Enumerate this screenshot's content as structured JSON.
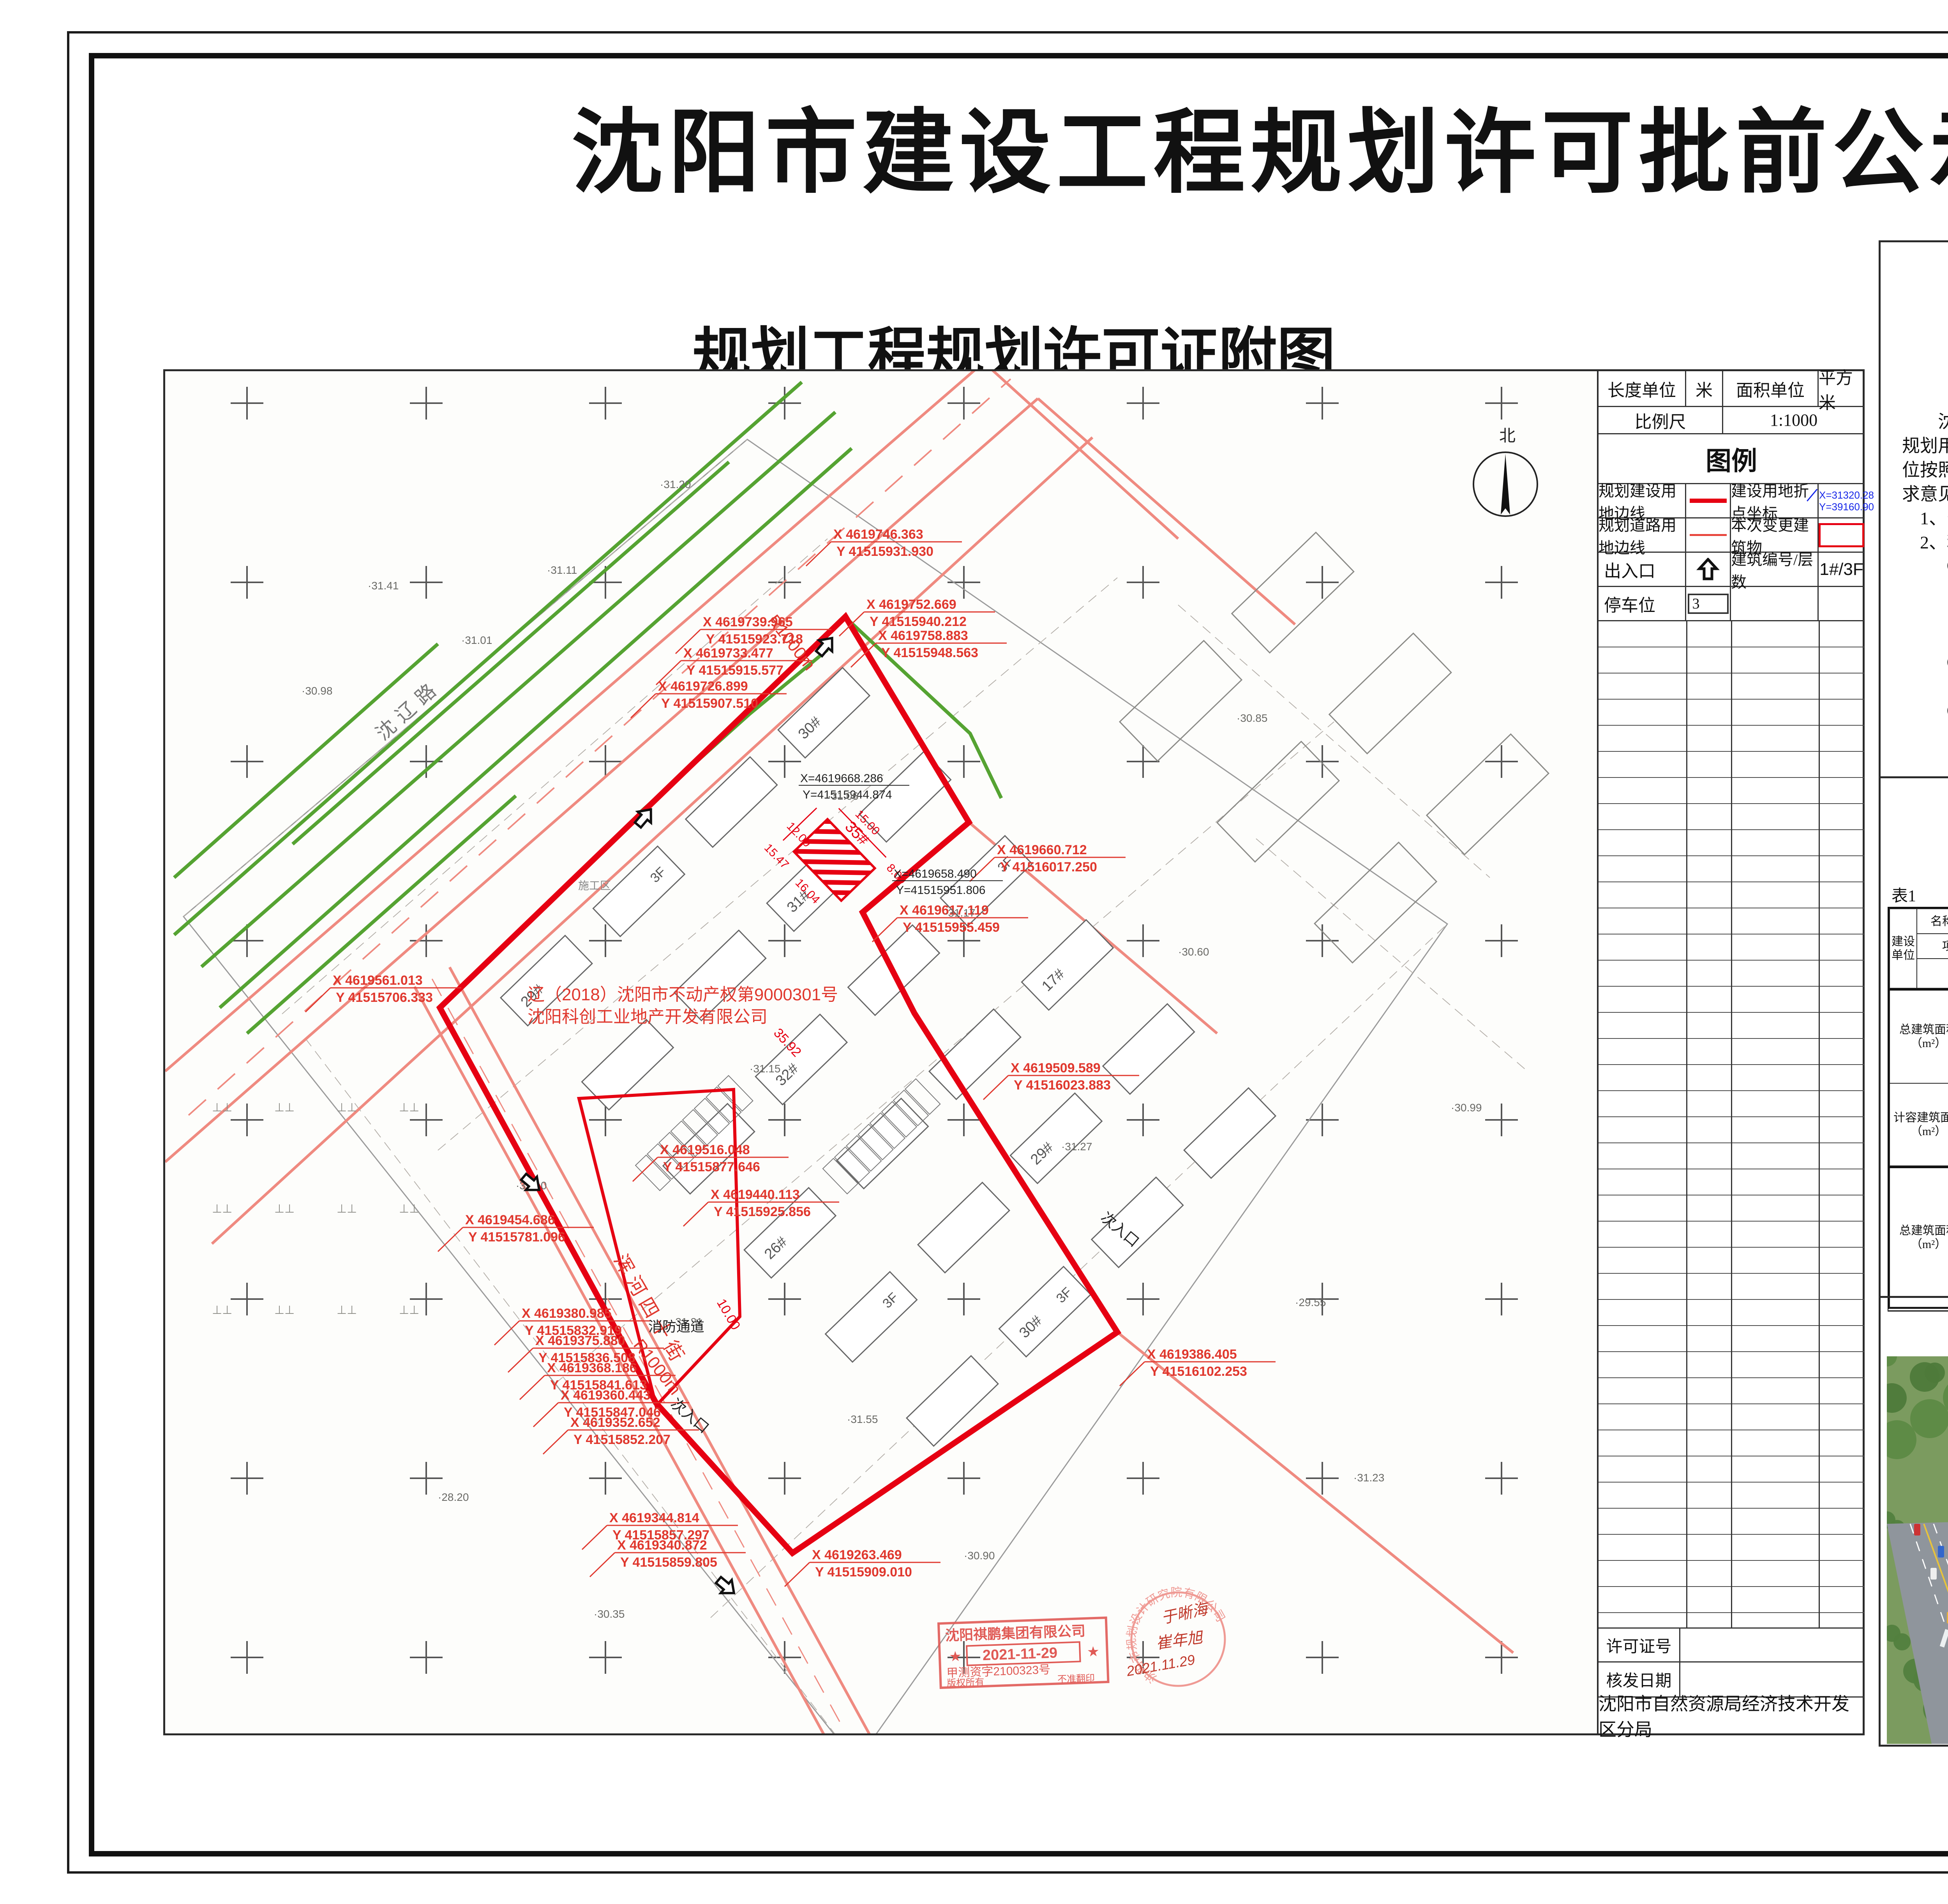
{
  "page_title": "沈阳市建设工程规划许可批前公示板",
  "map_sheet": {
    "title": "规划工程规划许可证附图",
    "units_row": {
      "length_label": "长度单位",
      "length_value": "米",
      "area_label": "面积单位",
      "area_value": "平方米"
    },
    "scale_row": {
      "label": "比例尺",
      "value": "1:1000"
    },
    "legend": {
      "header": "图例",
      "row1_left": "规划建设用地边线",
      "row1_right": "建设用地折点坐标",
      "row1_sample_x": "X=31320.28",
      "row1_sample_y": "Y=39160.90",
      "row2_left": "规划道路用地边线",
      "row2_right": "本次变更建筑物",
      "row3_left": "出入口",
      "row3_right": "建筑编号/层数",
      "row3_value": "1#/3F",
      "row4_left": "停车位",
      "row4_value": "3"
    },
    "footer": {
      "permit_no_label": "许可证号",
      "permit_no_value": "",
      "issue_date_label": "核发日期",
      "issue_date_value": "",
      "agency": "沈阳市自然资源局经济技术开发区分局"
    },
    "north_label": "北",
    "annotations": {
      "property_line1": "辽（2018）沈阳市不动产权第9000301号",
      "property_line2": "沈阳科创工业地产开发有限公司",
      "road_shenliao": "沈辽路",
      "road_hunhe": "浑河四十街",
      "radius_label": "R1000m",
      "secondary_entrance": "次入口",
      "main_entrance": "主入口",
      "fire_lane": "消防通道",
      "dim_10": "10.00",
      "construction_zone": "施工区",
      "building35": "35#",
      "dims": [
        "15.00",
        "8.00",
        "12.00",
        "15.47",
        "16.04",
        "35.92"
      ],
      "black_coords": [
        [
          "X=4619668.286",
          "Y=41515944.874"
        ],
        [
          "X=4619658.490",
          "Y=41515951.806"
        ]
      ],
      "red_coords": [
        [
          "X 4619746.363",
          "Y 41515931.930"
        ],
        [
          "X 4619752.669",
          "Y 41515940.212"
        ],
        [
          "X 4619758.883",
          "Y 41515948.563"
        ],
        [
          "X 4619739.965",
          "Y 41515923.718"
        ],
        [
          "X 4619733.477",
          "Y 41515915.577"
        ],
        [
          "X 4619726.899",
          "Y 41515907.510"
        ],
        [
          "X 4619561.013",
          "Y 41515706.333"
        ],
        [
          "X 4619660.712",
          "Y 41516017.250"
        ],
        [
          "X 4619617.119",
          "Y 41515955.459"
        ],
        [
          "X 4619509.589",
          "Y 41516023.883"
        ],
        [
          "X 4619516.048",
          "Y 41515877.646"
        ],
        [
          "X 4619440.113",
          "Y 41515925.856"
        ],
        [
          "X 4619454.686",
          "Y 41515781.096"
        ],
        [
          "X 4619380.985",
          "Y 41515832.919"
        ],
        [
          "X 4619375.880",
          "Y 41515836.508"
        ],
        [
          "X 4619368.186",
          "Y 41515841.613"
        ],
        [
          "X 4619360.443",
          "Y 41515847.046"
        ],
        [
          "X 4619352.652",
          "Y 41515852.207"
        ],
        [
          "X 4619344.814",
          "Y 41515857.297"
        ],
        [
          "X 4619340.872",
          "Y 41515859.805"
        ],
        [
          "X 4619263.469",
          "Y 41515909.010"
        ],
        [
          "X 4619386.405",
          "Y 41516102.253"
        ]
      ],
      "elevations": [
        "31.20",
        "31.41",
        "30.98",
        "31.11",
        "31.01",
        "31.06",
        "31.17",
        "31.15",
        "31.10",
        "31.21",
        "31.55",
        "31.27",
        "30.60",
        "29.55",
        "28.20",
        "30.35",
        "30.90",
        "31.23",
        "30.99",
        "30.85"
      ],
      "building_labels": [
        "29#",
        "30#",
        "31#",
        "32#",
        "26#",
        "17#"
      ],
      "floor_tag": "3F"
    },
    "stamps": {
      "rect_company": "沈阳祺鹏集团有限公司",
      "rect_date": "2021-11-29",
      "rect_cert": "甲测资字2100323号",
      "rect_rights": "版权所有",
      "rect_nocopy": "不准翻印",
      "round_company": "沈阳市规划设计研究院有限公司",
      "round_sign1": "于晰海",
      "round_sign2": "崔年旭",
      "round_date": "2021.11.29"
    }
  },
  "notice": {
    "header": "公示信息",
    "subtitle_line1": "沈阳科创工业地产开发有限公司位于沈阳经济技术开发区沈辽西路193号",
    "subtitle_line2": "的工业项目规划设计方案批前公示",
    "body_lines": [
      {
        "t": "沈阳科创工业地产开发有限公司位于沈阳经济技术开发区沈辽西路193号，",
        "a": "indent"
      },
      {
        "t": "规划用地性质为工业用地，面积为85894.02平方米。建设单位现已委托设计单",
        "a": ""
      },
      {
        "t": "位按照相关技术标准和规范完成建设工程规划设计方案，现予以公示并公开征",
        "a": ""
      },
      {
        "t": "求意见。",
        "a": ""
      },
      {
        "t": "1、公示及收集意见日期：2022年07月20日——2022年07月28日（7个工作日）",
        "a": "indent-s"
      },
      {
        "t": "2、利害关系人可在公示有效期内通过以下途径咨询或提出意见：",
        "a": "indent-s"
      },
      {
        "t": "①咨询电话：审批部门：沈阳市自然资源局经济技术开发区分局，",
        "a": "indent-m"
      },
      {
        "t": "024-81978559；",
        "a": "center"
      },
      {
        "t": "建设单位：沈阳科创工业地产开发有限公司，024-31011333；",
        "a": "indent-l"
      },
      {
        "t": "设计单位：辽宁大建筑设计有限公司，024-31356535；",
        "a": "indent-l"
      },
      {
        "t": "②信函请邮寄至：沈阳经济技术开发区中央大街27号开发区管委会13楼，",
        "a": "indent-m"
      },
      {
        "t": "中德园规划建设管理部（规划）收。",
        "a": "indent-l"
      },
      {
        "t": "③电子邮箱：gh25375039@163.com。",
        "a": "indent-m"
      },
      {
        "t": "沈阳市自然资源局经济技术开发区分局",
        "a": "right"
      },
      {
        "t": "2022年07月20日",
        "a": "right2"
      }
    ]
  },
  "indicator_table": {
    "title": "建设项目经济技术指标统计表",
    "table_no": "表1",
    "fill_date": "填表日期：  2022 年 07 月 19 日",
    "jsdw": "建设单位",
    "mc": "名称（公章）",
    "mc_v": "沈阳科创工业地产开发有限公司",
    "xmdz": "项目地址",
    "xmdz_v": "沈阳市经济技术开发区沈辽西路193号",
    "lxr": "联系人",
    "lxr_v": "张鹏",
    "lxdh": "联系电话",
    "lxdh_v": "15840526543",
    "sjdw": "设计单位",
    "mc2": "名称（公章）",
    "mc2_v": "辽宁大建筑设计有限公司",
    "zzdj": "资质等级（建筑、规划）",
    "zzdj_v": "建筑甲级",
    "lxr2": "联系人",
    "lxr2_v": "胡志弘",
    "zzh": "设计资质证号",
    "zzh_v": "A121008556",
    "lxdh2": "联系电话",
    "lxdh2_v": "13386873300",
    "zjzmj": "总建筑面积（m²）",
    "zjzmj_v": "88641.94（本次540.00）",
    "ds": "地上（m²）",
    "ds_v": "88241.87（本次540.00）",
    "jsydmj": "建设用地面积（m²）",
    "jsydmj_v": "85894.02",
    "jzmd": "建筑密度（%）",
    "jzmd_v": "36.40（本次0.21）",
    "dx": "地下（m²）",
    "dx_v": "400.07（本次0）",
    "jdmj": "基底面积（m²）",
    "jdmj_v": "31266.51（本次180.00）",
    "ldl": "绿地率（%）",
    "ldl_v": "12",
    "jrjzmj": "计容建筑面积（m²）",
    "jrjzmj_v": "89423.51（本次540.00）",
    "ds2": "地上（m²）",
    "ds2_v": "89423.51(540.00)",
    "ldmj": "绿地面积（m²）",
    "ldmj_v": "10307",
    "xzbg": "行政办公及生活服务设施比例（%）",
    "xzbg_v": "0",
    "dx2": "地下（m²）",
    "dx2_v": "0",
    "rjl": "容积率",
    "rjl_v": "1.04（本次0.006）",
    "dshu": "栋数",
    "dshu_v": "29（本次1）",
    "tcw": "停车位（个）",
    "tcw_v": "359（本次2）",
    "zjzmj2": "总建筑面积（m²）",
    "dsjz": "地上建筑面积（m²）",
    "dsjz_v": "88241.87（本次540.00）",
    "scmj": "生产面积（m²）",
    "scmj_v": "88241.87（本次540.00）",
    "bgmj": "办公面积（m²）",
    "bgmj_v": "-",
    "fsmj": "附属面积（m²）",
    "fsmj_v": "-",
    "qtmj": "其他（可添加）面积（m²）",
    "qtmj_v": "-",
    "dxjz": "地下建筑面积（m²）",
    "dxjz_v": "400.07（本次0）",
    "fsmj2": "附属面积（m²）",
    "fsmj2_v": "-",
    "qtmj2": "其他（可添加）面积（m²）",
    "qtmj2_v": "-",
    "note": "建筑面积依据《建筑工程建筑面积计算规范》(GBT50353-2013)　容积率依据《关于修订〈辽宁省住宅与公建用地容积率计算管理规定〉的通知》(辽住建【2015】94号)"
  },
  "birdseye": {
    "title": "鸟瞰图",
    "building_tag": "35#楼"
  },
  "colors": {
    "boundary_red": "#e60012",
    "road_salmon": "#ef8a80",
    "green_line": "#55a332",
    "legend_blue": "#1626e8",
    "stamp_red": "#e05a55"
  }
}
